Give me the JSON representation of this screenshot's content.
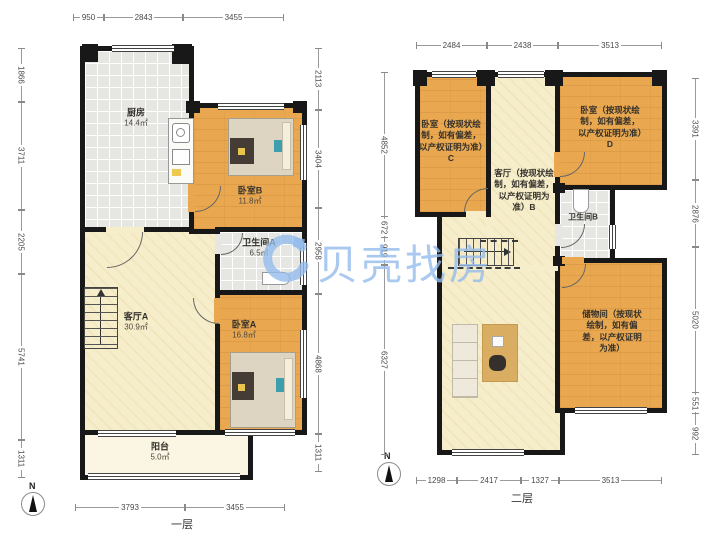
{
  "watermark": {
    "brand": "贝壳找房"
  },
  "colors": {
    "wood": "#e9a850",
    "tile": "#e6e6e2",
    "cream": "#f6eecb",
    "wall": "#181818",
    "watermark_blue": "#93bcec"
  },
  "floor1": {
    "label": "一层",
    "compass_label": "N",
    "rooms": {
      "kitchen": {
        "name": "厨房",
        "area": "14.4㎡"
      },
      "bedroom_b": {
        "name": "卧室B",
        "area": "11.8㎡"
      },
      "bath_a": {
        "name": "卫生间A",
        "area": "6.5㎡"
      },
      "living_a": {
        "name": "客厅A",
        "area": "30.9㎡"
      },
      "bedroom_a": {
        "name": "卧室A",
        "area": "16.8㎡"
      },
      "balcony": {
        "name": "阳台",
        "area": "5.0㎡"
      }
    },
    "dims": {
      "top": [
        "950",
        "2843",
        "3455"
      ],
      "left": [
        "1866",
        "3711",
        "2205",
        "5741",
        "1311"
      ],
      "right": [
        "2113",
        "3404",
        "2958",
        "4868",
        "1311"
      ],
      "bottom": [
        "3793",
        "3455"
      ]
    }
  },
  "floor2": {
    "label": "二层",
    "compass_label": "N",
    "rooms": {
      "bedroom_c": {
        "name": "卧室（按现状绘制，如有偏差，以产权证明为准）C"
      },
      "hall_b": {
        "name": "客厅（按现状绘制，如有偏差，以产权证明为准）B"
      },
      "bedroom_d": {
        "name": "卧室（按现状绘制，如有偏差，以产权证明为准）D"
      },
      "bath_b": {
        "name": "卫生间B"
      },
      "storage": {
        "name": "储物间（按现状绘制，如有偏差，以产权证明为准）"
      }
    },
    "dims": {
      "top": [
        "2484",
        "2438",
        "3513"
      ],
      "left": [
        "4852",
        "672",
        "919",
        "6327"
      ],
      "right": [
        "3391",
        "2876",
        "5020",
        "551",
        "992"
      ],
      "bottom": [
        "1298",
        "2417",
        "1327",
        "3513"
      ]
    }
  }
}
